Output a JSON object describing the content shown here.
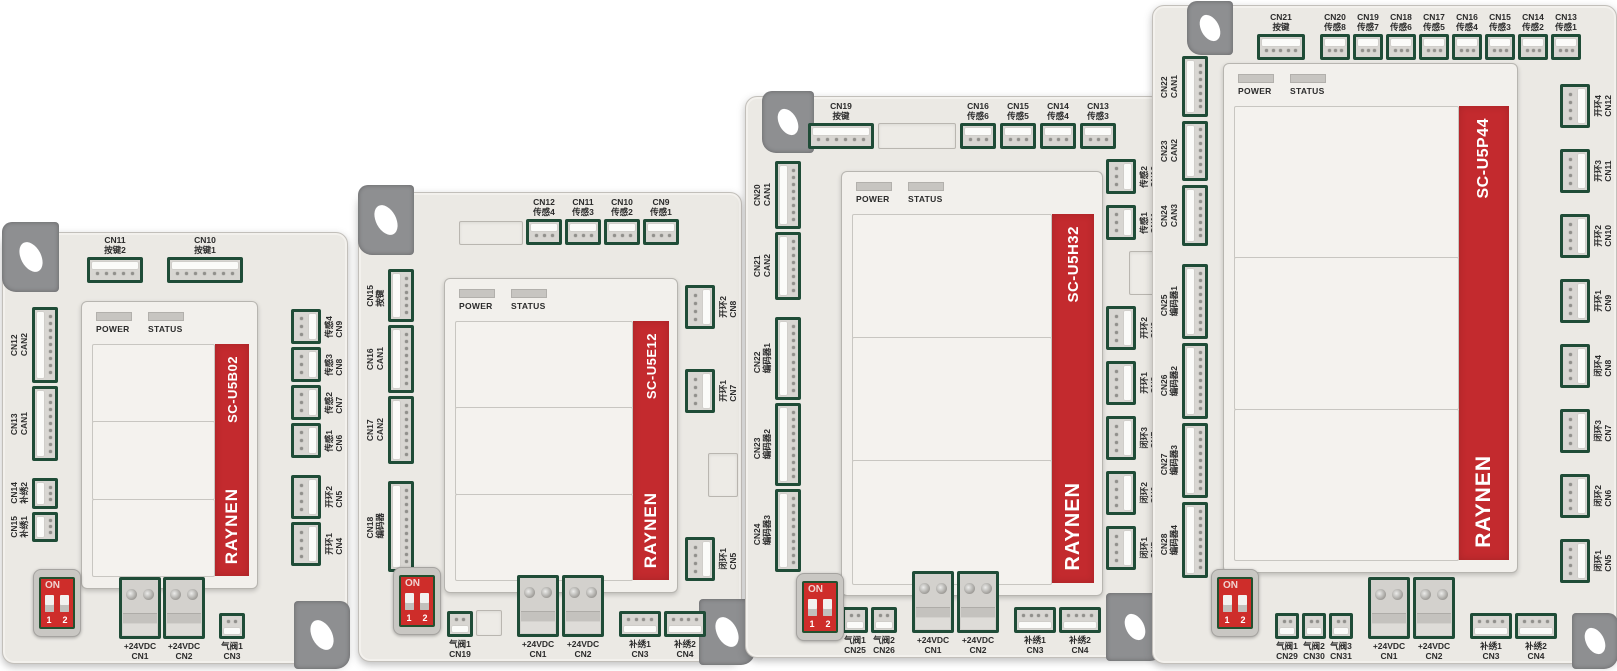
{
  "common": {
    "brand": {
      "logo": "RAYNEN"
    },
    "leds": {
      "power": "POWER",
      "status": "STATUS"
    },
    "dip": {
      "on": "ON",
      "sw1": "1",
      "sw2": "2"
    },
    "colors": {
      "accent_red": "#c32a2e",
      "connector_green": "#1f4c37",
      "body_gray": "#ebe9e4",
      "tab_gray": "#8e8f91"
    }
  },
  "boards": [
    {
      "model": "SC-U5B02",
      "sections": 3,
      "top": [
        {
          "id": "CN11",
          "label": "按键2",
          "type": "h",
          "pins": 5
        },
        {
          "id": "CN10",
          "label": "按键1",
          "type": "h",
          "pins": 7
        }
      ],
      "left": [
        {
          "id": "CN12",
          "label": "CAN2",
          "type": "v",
          "pins": 9
        },
        {
          "id": "CN13",
          "label": "CAN1",
          "type": "v",
          "pins": 9
        },
        {
          "id": "CN14",
          "label": "补绣2",
          "type": "v",
          "pins": 3,
          "gap": true
        },
        {
          "id": "CN15",
          "label": "补绣1",
          "type": "v",
          "pins": 3
        }
      ],
      "right": [
        {
          "id": "CN9",
          "label": "传感4",
          "type": "r",
          "pins": 3
        },
        {
          "id": "CN8",
          "label": "传感3",
          "type": "r",
          "pins": 3
        },
        {
          "id": "CN7",
          "label": "传感2",
          "type": "r",
          "pins": 3
        },
        {
          "id": "CN6",
          "label": "传感1",
          "type": "r",
          "pins": 3
        },
        {
          "id": "CN5",
          "label": "开环2",
          "type": "r",
          "pins": 4,
          "gap": true
        },
        {
          "id": "CN4",
          "label": "开环1",
          "type": "r",
          "pins": 4
        }
      ],
      "bottom": [
        {
          "id": "CN1",
          "label": "+24VDC",
          "type": "power"
        },
        {
          "id": "CN2",
          "label": "+24VDC",
          "type": "power"
        },
        {
          "id": "CN3",
          "label": "气阀1",
          "type": "s",
          "pins": 2,
          "gap": true
        }
      ]
    },
    {
      "model": "SC-U5E12",
      "sections": 3,
      "top": [
        {
          "type": "empty",
          "w": 64,
          "h": 24
        },
        {
          "id": "CN12",
          "label": "传感4",
          "type": "h",
          "pins": 3
        },
        {
          "id": "CN11",
          "label": "传感3",
          "type": "h",
          "pins": 3
        },
        {
          "id": "CN10",
          "label": "传感2",
          "type": "h",
          "pins": 3
        },
        {
          "id": "CN9",
          "label": "传感1",
          "type": "h",
          "pins": 3
        }
      ],
      "left": [
        {
          "id": "CN15",
          "label": "按键",
          "type": "v",
          "pins": 6
        },
        {
          "id": "CN16",
          "label": "CAN1",
          "type": "v",
          "pins": 8
        },
        {
          "id": "CN17",
          "label": "CAN2",
          "type": "v",
          "pins": 8
        },
        {
          "id": "CN18",
          "label": "编码器",
          "type": "v",
          "pins": 11,
          "gap": true
        }
      ],
      "right": [
        {
          "id": "CN8",
          "label": "开环2",
          "type": "r",
          "pins": 4
        },
        {
          "id": "CN7",
          "label": "开环1",
          "type": "r",
          "pins": 4
        },
        {
          "type": "empty",
          "w": 30,
          "h": 44
        },
        {
          "id": "CN5",
          "label": "闭环1",
          "type": "r",
          "pins": 4
        }
      ],
      "bottom": [
        {
          "id": "CN19",
          "label": "气阀1",
          "type": "s",
          "pins": 2
        },
        {
          "type": "empty",
          "w": 26,
          "h": 26
        },
        {
          "id": "CN1",
          "label": "+24VDC",
          "type": "power",
          "gap": true
        },
        {
          "id": "CN2",
          "label": "+24VDC",
          "type": "power"
        },
        {
          "id": "CN3",
          "label": "补绣1",
          "type": "s",
          "pins": 4,
          "gap": true
        },
        {
          "id": "CN4",
          "label": "补绣2",
          "type": "s",
          "pins": 4
        }
      ]
    },
    {
      "model": "SC-U5H32",
      "sections": 3,
      "top": [
        {
          "id": "CN19",
          "label": "按键",
          "type": "h",
          "pins": 6
        },
        {
          "type": "empty",
          "w": 78,
          "h": 26
        },
        {
          "id": "CN16",
          "label": "传感6",
          "type": "h",
          "pins": 3
        },
        {
          "id": "CN15",
          "label": "传感5",
          "type": "h",
          "pins": 3
        },
        {
          "id": "CN14",
          "label": "传感4",
          "type": "h",
          "pins": 3
        },
        {
          "id": "CN13",
          "label": "传感3",
          "type": "h",
          "pins": 3
        }
      ],
      "left": [
        {
          "id": "CN20",
          "label": "CAN1",
          "type": "v",
          "pins": 8
        },
        {
          "id": "CN21",
          "label": "CAN2",
          "type": "v",
          "pins": 8
        },
        {
          "id": "CN22",
          "label": "编码器1",
          "type": "v",
          "pins": 10,
          "gap": true
        },
        {
          "id": "CN23",
          "label": "编码器2",
          "type": "v",
          "pins": 10
        },
        {
          "id": "CN24",
          "label": "编码器3",
          "type": "v",
          "pins": 10
        }
      ],
      "right": [
        {
          "id": "CN12",
          "label": "传感2",
          "type": "r",
          "pins": 3
        },
        {
          "id": "CN11",
          "label": "传感1",
          "type": "r",
          "pins": 3
        },
        {
          "type": "empty",
          "w": 30,
          "h": 44
        },
        {
          "id": "CN9",
          "label": "开环2",
          "type": "r",
          "pins": 4
        },
        {
          "id": "CN8",
          "label": "开环1",
          "type": "r",
          "pins": 4
        },
        {
          "id": "CN7",
          "label": "闭环3",
          "type": "r",
          "pins": 4
        },
        {
          "id": "CN6",
          "label": "闭环2",
          "type": "r",
          "pins": 4
        },
        {
          "id": "CN5",
          "label": "闭环1",
          "type": "r",
          "pins": 4
        }
      ],
      "bottom": [
        {
          "id": "CN25",
          "label": "气阀1",
          "type": "s",
          "pins": 2
        },
        {
          "id": "CN26",
          "label": "气阀2",
          "type": "s",
          "pins": 2
        },
        {
          "id": "CN1",
          "label": "+24VDC",
          "type": "power",
          "gap": true
        },
        {
          "id": "CN2",
          "label": "+24VDC",
          "type": "power"
        },
        {
          "id": "CN3",
          "label": "补绣1",
          "type": "s",
          "pins": 4,
          "gap": true
        },
        {
          "id": "CN4",
          "label": "补绣2",
          "type": "s",
          "pins": 4
        }
      ]
    },
    {
      "model": "SC-U5P44",
      "sections": 3,
      "top": [
        {
          "id": "CN21",
          "label": "按键",
          "type": "h",
          "pins": 5,
          "w": 48
        },
        {
          "id": "CN20",
          "label": "传感8",
          "type": "h",
          "pins": 3,
          "w": 30,
          "gap": true
        },
        {
          "id": "CN19",
          "label": "传感7",
          "type": "h",
          "pins": 3,
          "w": 30
        },
        {
          "id": "CN18",
          "label": "传感6",
          "type": "h",
          "pins": 3,
          "w": 30
        },
        {
          "id": "CN17",
          "label": "传感5",
          "type": "h",
          "pins": 3,
          "w": 30
        },
        {
          "id": "CN16",
          "label": "传感4",
          "type": "h",
          "pins": 3,
          "w": 30
        },
        {
          "id": "CN15",
          "label": "传感3",
          "type": "h",
          "pins": 3,
          "w": 30
        },
        {
          "id": "CN14",
          "label": "传感2",
          "type": "h",
          "pins": 3,
          "w": 30
        },
        {
          "id": "CN13",
          "label": "传感1",
          "type": "h",
          "pins": 3,
          "w": 30
        }
      ],
      "left": [
        {
          "id": "CN22",
          "label": "CAN1",
          "type": "v",
          "pins": 7
        },
        {
          "id": "CN23",
          "label": "CAN2",
          "type": "v",
          "pins": 7
        },
        {
          "id": "CN24",
          "label": "CAN3",
          "type": "v",
          "pins": 7
        },
        {
          "id": "CN25",
          "label": "编码器1",
          "type": "v",
          "pins": 9,
          "gap": true
        },
        {
          "id": "CN26",
          "label": "编码器2",
          "type": "v",
          "pins": 9
        },
        {
          "id": "CN27",
          "label": "编码器3",
          "type": "v",
          "pins": 9
        },
        {
          "id": "CN28",
          "label": "编码器4",
          "type": "v",
          "pins": 9
        }
      ],
      "right": [
        {
          "id": "CN12",
          "label": "开环4",
          "type": "r",
          "pins": 4
        },
        {
          "id": "CN11",
          "label": "开环3",
          "type": "r",
          "pins": 4
        },
        {
          "id": "CN10",
          "label": "开环2",
          "type": "r",
          "pins": 4
        },
        {
          "id": "CN9",
          "label": "开环1",
          "type": "r",
          "pins": 4
        },
        {
          "id": "CN8",
          "label": "闭环4",
          "type": "r",
          "pins": 4
        },
        {
          "id": "CN7",
          "label": "闭环3",
          "type": "r",
          "pins": 4
        },
        {
          "id": "CN6",
          "label": "闭环2",
          "type": "r",
          "pins": 4
        },
        {
          "id": "CN5",
          "label": "闭环1",
          "type": "r",
          "pins": 4
        }
      ],
      "bottom": [
        {
          "id": "CN29",
          "label": "气阀1",
          "type": "s",
          "pins": 2,
          "w": 24
        },
        {
          "id": "CN30",
          "label": "气阀2",
          "type": "s",
          "pins": 2,
          "w": 24
        },
        {
          "id": "CN31",
          "label": "气阀3",
          "type": "s",
          "pins": 2,
          "w": 24
        },
        {
          "id": "CN1",
          "label": "+24VDC",
          "type": "power",
          "gap": true
        },
        {
          "id": "CN2",
          "label": "+24VDC",
          "type": "power"
        },
        {
          "id": "CN3",
          "label": "补绣1",
          "type": "s",
          "pins": 4,
          "gap": true
        },
        {
          "id": "CN4",
          "label": "补绣2",
          "type": "s",
          "pins": 4
        }
      ]
    }
  ]
}
